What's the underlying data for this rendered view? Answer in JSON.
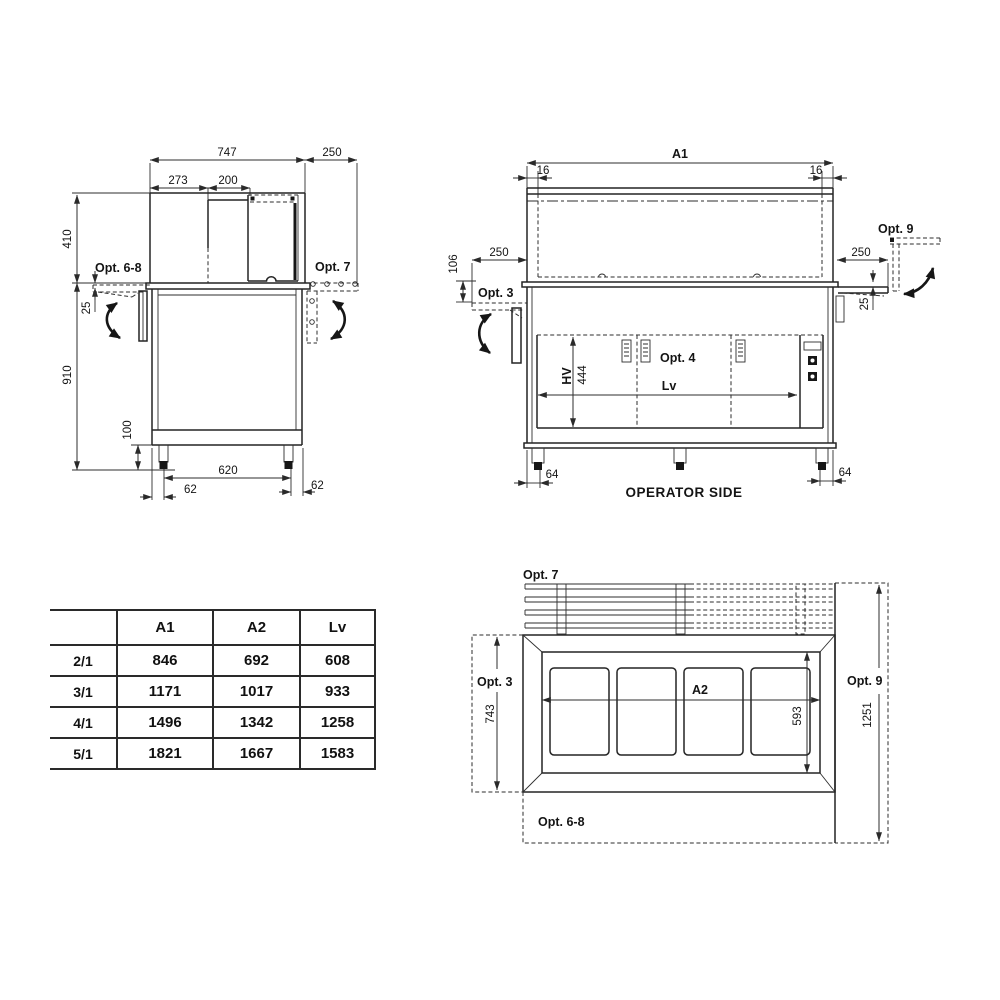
{
  "side_view": {
    "dims": {
      "d747": "747",
      "d250": "250",
      "d273": "273",
      "d200": "200",
      "d410": "410",
      "d25": "25",
      "d910": "910",
      "d100": "100",
      "d620": "620",
      "d62_left": "62",
      "d62_right": "62"
    },
    "labels": {
      "opt68": "Opt. 6-8",
      "opt7": "Opt. 7"
    }
  },
  "front_view": {
    "dims": {
      "a1": "A1",
      "d16_left": "16",
      "d16_right": "16",
      "d106": "106",
      "d250_left": "250",
      "d250_right": "250",
      "d25": "25",
      "hv": "HV",
      "d444": "444",
      "lv": "Lv",
      "d64_left": "64",
      "d64_right": "64"
    },
    "labels": {
      "opt3": "Opt. 3",
      "opt4": "Opt. 4",
      "opt9": "Opt. 9"
    },
    "caption": "OPERATOR SIDE"
  },
  "top_view": {
    "dims": {
      "a2": "A2",
      "d743": "743",
      "d593": "593",
      "d1251": "1251"
    },
    "labels": {
      "opt7": "Opt. 7",
      "opt3": "Opt. 3",
      "opt9": "Opt. 9",
      "opt68": "Opt. 6-8"
    }
  },
  "table": {
    "col_headers": [
      "A1",
      "A2",
      "Lv"
    ],
    "rows": [
      {
        "model": "2/1",
        "A1": "846",
        "A2": "692",
        "Lv": "608"
      },
      {
        "model": "3/1",
        "A1": "1171",
        "A2": "1017",
        "Lv": "933"
      },
      {
        "model": "4/1",
        "A1": "1496",
        "A2": "1342",
        "Lv": "1258"
      },
      {
        "model": "5/1",
        "A1": "1821",
        "A2": "1667",
        "Lv": "1583"
      }
    ]
  },
  "colors": {
    "line": "#242424",
    "text": "#141414",
    "background": "#ffffff"
  }
}
